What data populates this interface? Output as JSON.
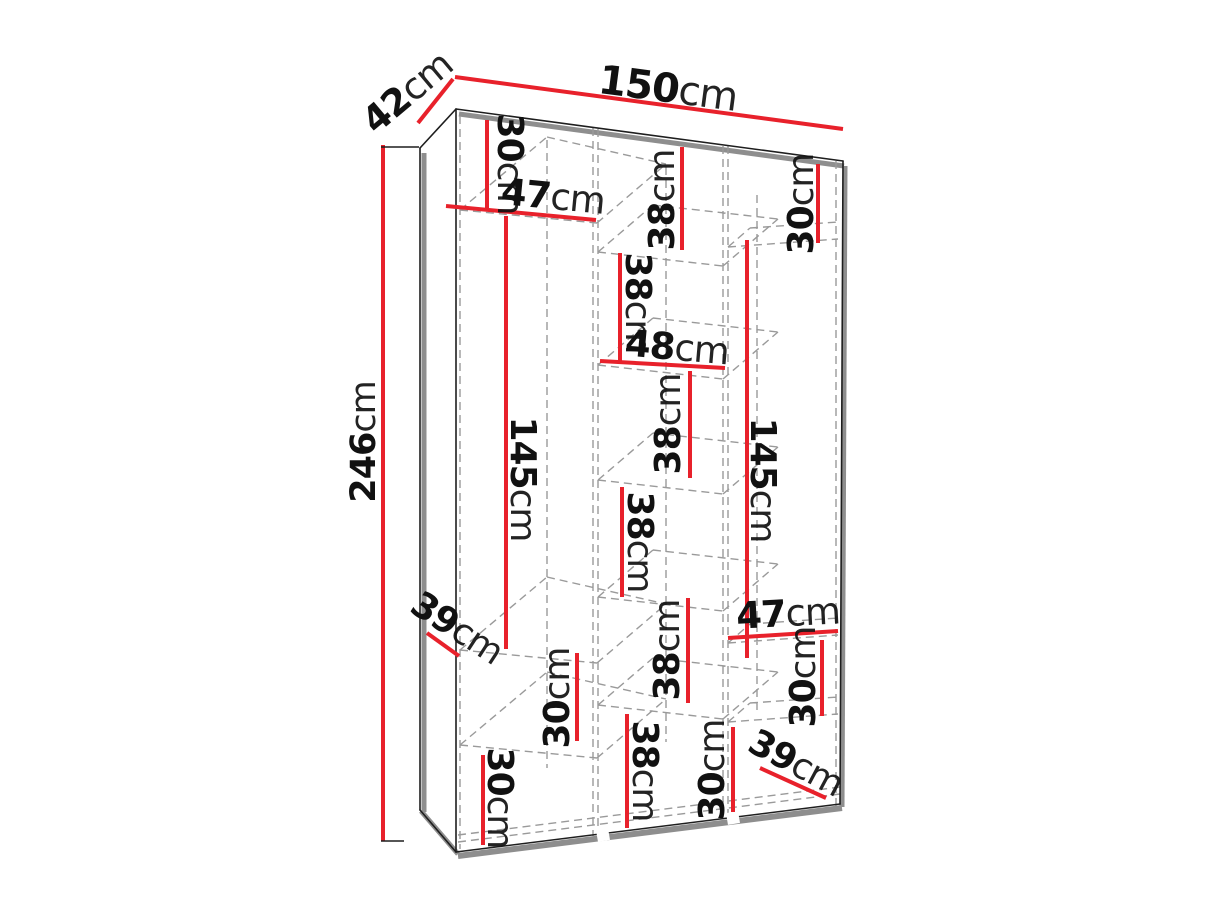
{
  "diagram": {
    "kind": "wardrobe-internal-dimensions",
    "colors": {
      "dimension_line": "#e8212b",
      "outline": "#1e1e1e",
      "shadow": "#8e8e8e",
      "hidden_edge_dash": "#9a9a9a",
      "background": "#ffffff"
    },
    "labels": {
      "width_150": {
        "value": "150",
        "unit": "cm"
      },
      "depth_42": {
        "value": "42",
        "unit": "cm"
      },
      "height_246": {
        "value": "246",
        "unit": "cm"
      },
      "left_top_30": {
        "value": "30",
        "unit": "cm"
      },
      "left_47": {
        "value": "47",
        "unit": "cm"
      },
      "mid_top_38": {
        "value": "38",
        "unit": "cm"
      },
      "right_top_30": {
        "value": "30",
        "unit": "cm"
      },
      "mid_38_2": {
        "value": "38",
        "unit": "cm"
      },
      "mid_48": {
        "value": "48",
        "unit": "cm"
      },
      "mid_38_3": {
        "value": "38",
        "unit": "cm"
      },
      "left_145": {
        "value": "145",
        "unit": "cm"
      },
      "right_145": {
        "value": "145",
        "unit": "cm"
      },
      "mid_38_4": {
        "value": "38",
        "unit": "cm"
      },
      "mid_38_5": {
        "value": "38",
        "unit": "cm"
      },
      "right_47": {
        "value": "47",
        "unit": "cm"
      },
      "right_30_2": {
        "value": "30",
        "unit": "cm"
      },
      "left_39": {
        "value": "39",
        "unit": "cm"
      },
      "left_30_2": {
        "value": "30",
        "unit": "cm"
      },
      "left_30_3": {
        "value": "30",
        "unit": "cm"
      },
      "mid_38_6": {
        "value": "38",
        "unit": "cm"
      },
      "right_part_30": {
        "value": "30",
        "unit": "cm"
      },
      "right_39": {
        "value": "39",
        "unit": "cm"
      }
    }
  }
}
